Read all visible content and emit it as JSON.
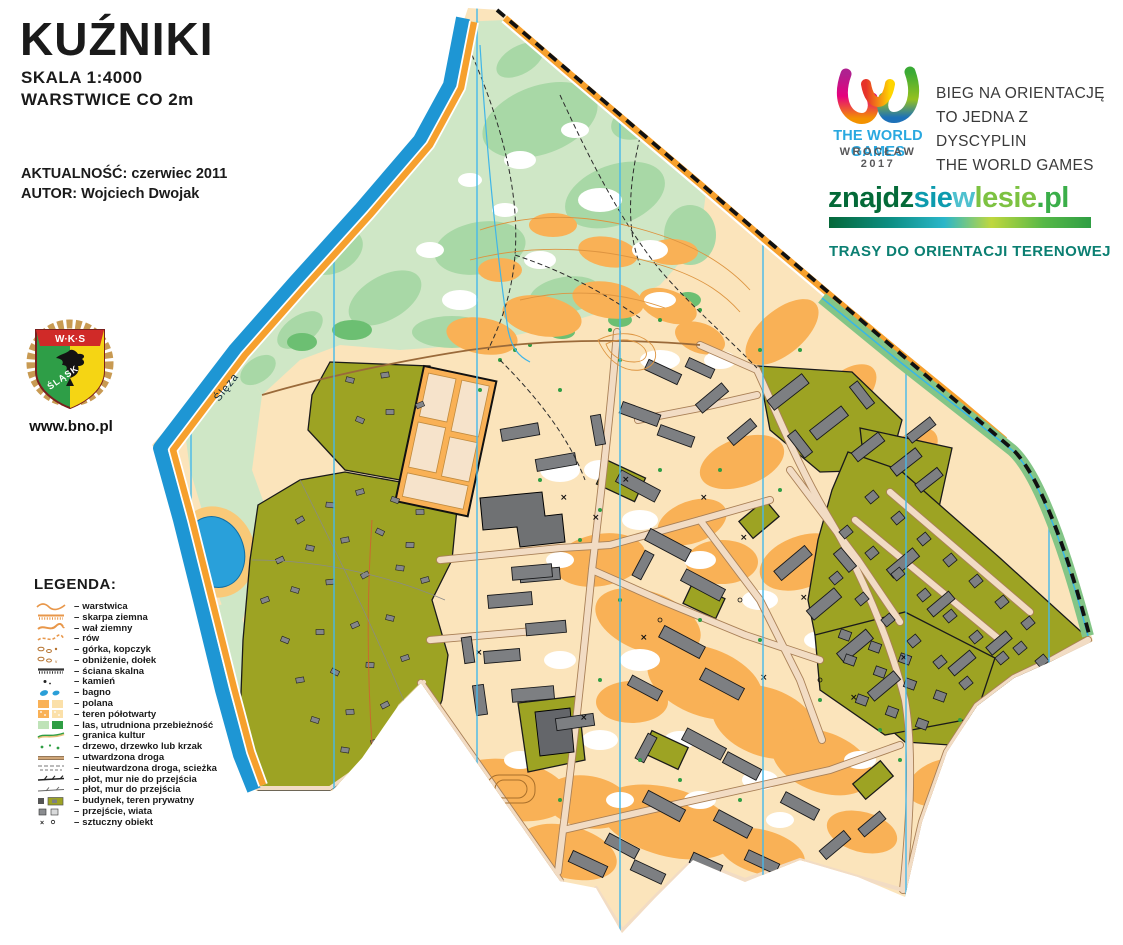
{
  "header": {
    "title": "KUŹNIKI",
    "scale": "SKALA 1:4000",
    "contour_interval": "WARSTWICE CO 2m",
    "currency": "AKTUALNOŚĆ: czerwiec 2011",
    "author": "AUTOR: Wojciech Dwojak",
    "website": "www.bno.pl"
  },
  "crest": {
    "club_initials": "W·K·S",
    "club_name": "ŚLĄSK"
  },
  "world_games": {
    "logo_title": "THE WORLD GAMES",
    "logo_subtitle": "WROCŁAW 2017",
    "brand_color": "#29a8e0",
    "tagline_lines": [
      "BIEG NA ORIENTACJĘ",
      "TO JEDNA Z DYSCYPLIN",
      "THE WORLD GAMES"
    ]
  },
  "znajdziewlesie": {
    "domain_parts": [
      {
        "text": "znajdz",
        "color": "#046a38"
      },
      {
        "text": "sie",
        "color": "#0d9bae"
      },
      {
        "text": "w",
        "color": "#4fc1cf"
      },
      {
        "text": "lesie",
        "color": "#7dc242"
      },
      {
        "text": ".pl",
        "color": "#3aae49"
      }
    ],
    "tagline": "TRASY DO ORIENTACJI TERENOWEJ",
    "tagline_color": "#0b7f72"
  },
  "legend": {
    "title": "LEGENDA:",
    "separator": "–",
    "items": [
      {
        "icon": "contour",
        "label": "warstwica"
      },
      {
        "icon": "earthbank",
        "label": "skarpa ziemna"
      },
      {
        "icon": "earthwall",
        "label": "wał ziemny"
      },
      {
        "icon": "ditch",
        "label": "rów"
      },
      {
        "icon": "knoll",
        "label": "górka, kopczyk"
      },
      {
        "icon": "depression",
        "label": "obniżenie, dołek"
      },
      {
        "icon": "rockwall",
        "label": "ściana skalna"
      },
      {
        "icon": "stone",
        "label": "kamień"
      },
      {
        "icon": "marsh",
        "label": "bagno"
      },
      {
        "icon": "clearing",
        "label": "polana"
      },
      {
        "icon": "semiopen",
        "label": "teren półotwarty"
      },
      {
        "icon": "forest",
        "label": "las, utrudniona przebieżność"
      },
      {
        "icon": "cultivation",
        "label": "granica kultur"
      },
      {
        "icon": "tree",
        "label": "drzewo, drzewko lub krzak"
      },
      {
        "icon": "paved",
        "label": "utwardzona droga"
      },
      {
        "icon": "unpaved",
        "label": "nieutwardzona droga, scieżka"
      },
      {
        "icon": "fence-imp",
        "label": "płot, mur nie do przejścia"
      },
      {
        "icon": "fence-pass",
        "label": "płot, mur do przejścia"
      },
      {
        "icon": "building",
        "label": "budynek, teren prywatny"
      },
      {
        "icon": "canopy",
        "label": "przejście, wiata"
      },
      {
        "icon": "artificial",
        "label": "sztuczny obiekt"
      }
    ]
  },
  "map": {
    "river_label": "Ślęza",
    "colors": {
      "river": "#1e96d4",
      "pond": "#29a0da",
      "roadband": "#f6a02d",
      "forest1": "#cfe7c6",
      "forest2": "#a8d8a6",
      "forest3": "#6cbf72",
      "open": "#fbe4bb",
      "orange": "#f9b156",
      "olive": "#9da323",
      "bldg": "#7d7f82",
      "street": "#f2dcc4",
      "street-edge": "#a98057",
      "meridian": "#45b8ea",
      "greenstrip": "#83c586"
    }
  }
}
